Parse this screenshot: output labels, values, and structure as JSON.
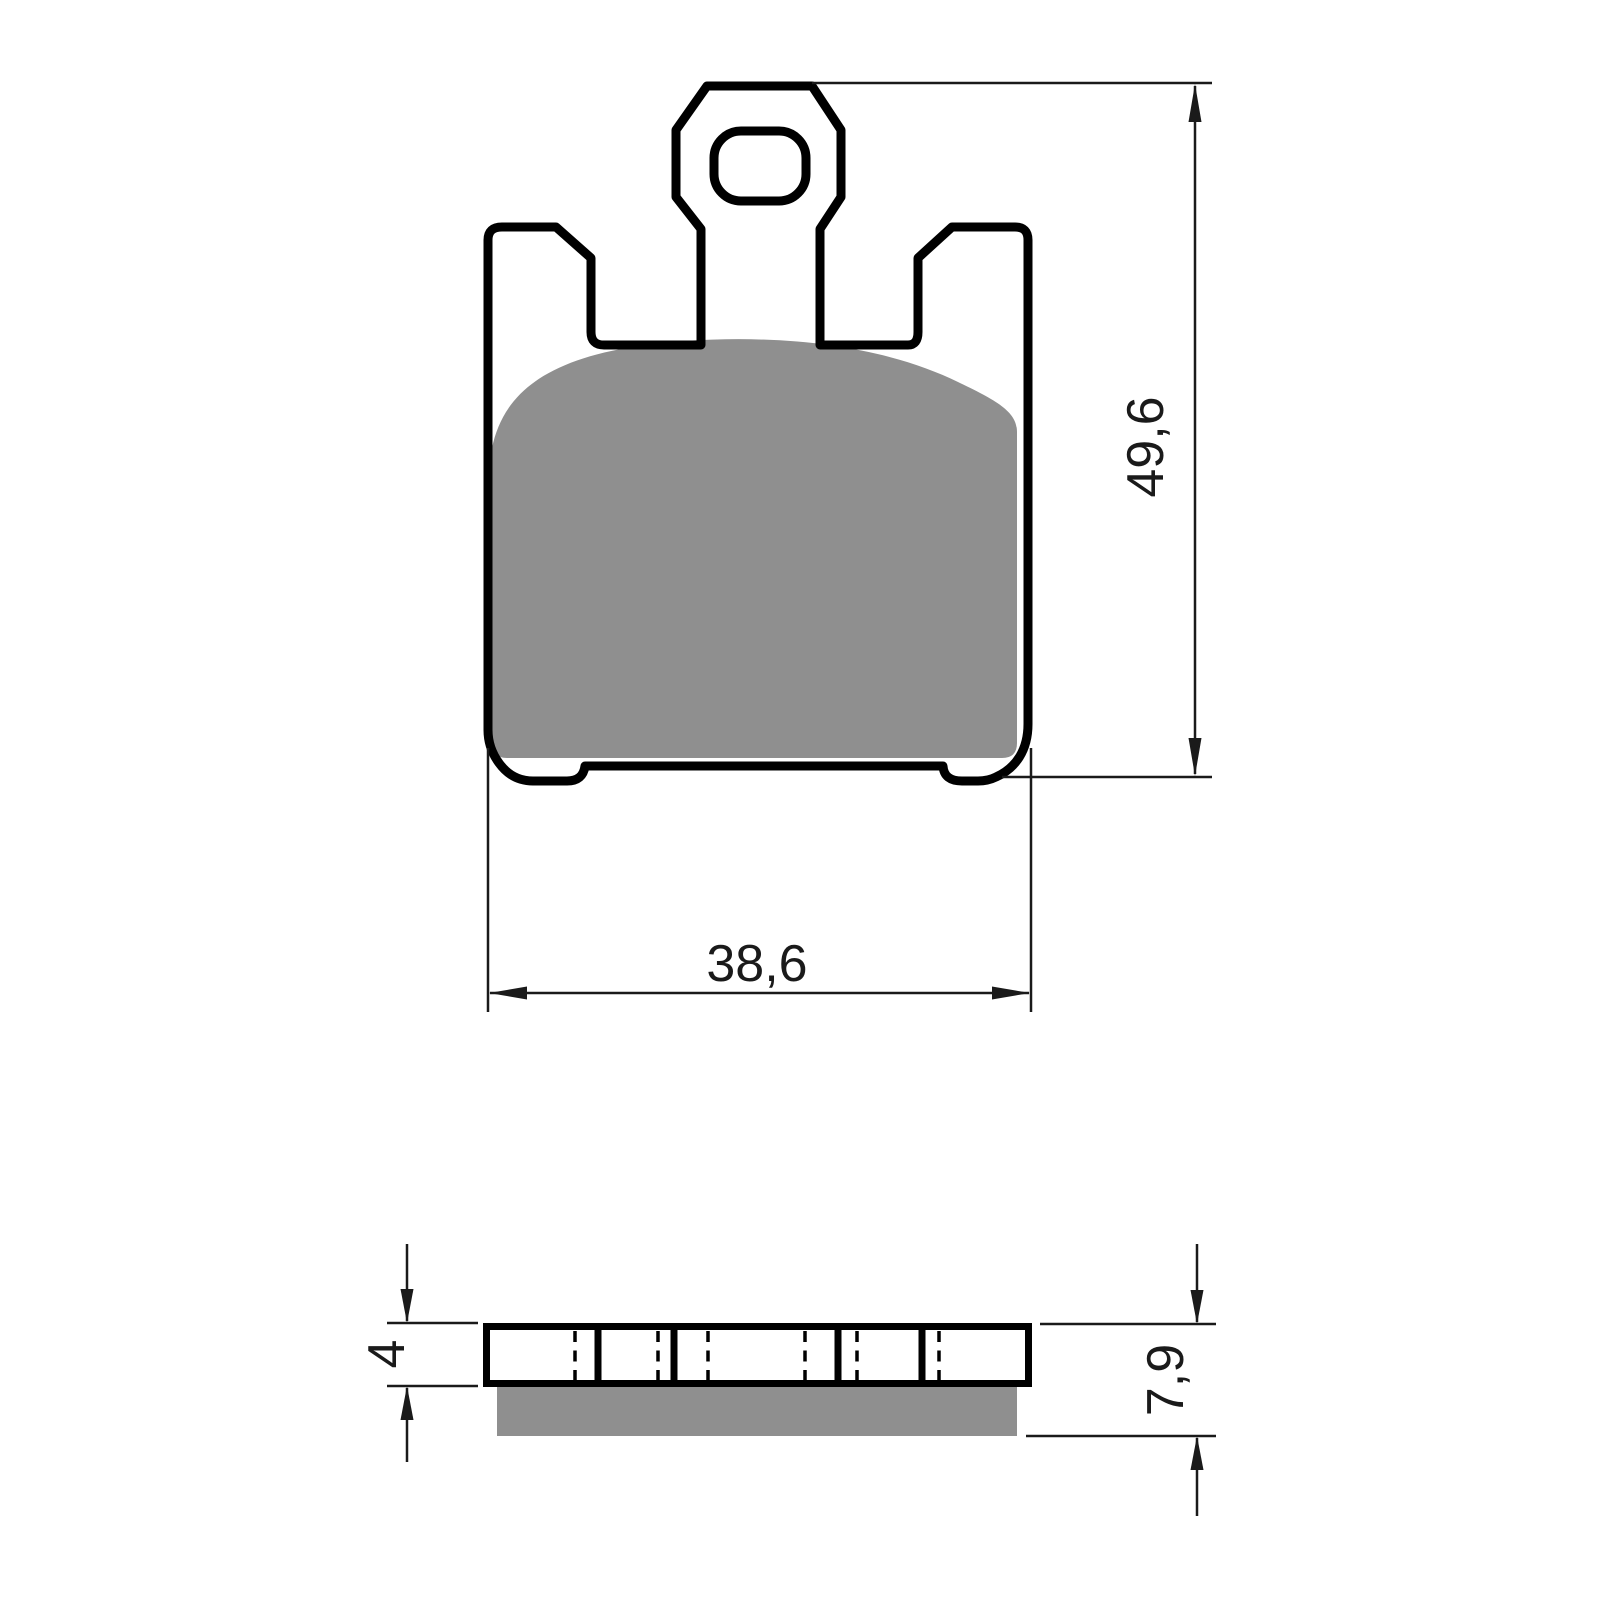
{
  "drawing": {
    "type": "brake-pad-technical-drawing",
    "colors": {
      "background": "#ffffff",
      "line": "#000000",
      "friction_material": "#8f8f8f"
    },
    "front_view": {
      "height_label": "49,6",
      "width_label": "38,6"
    },
    "side_view": {
      "backplate_thickness_label": "4",
      "total_thickness_label": "7,9"
    }
  }
}
